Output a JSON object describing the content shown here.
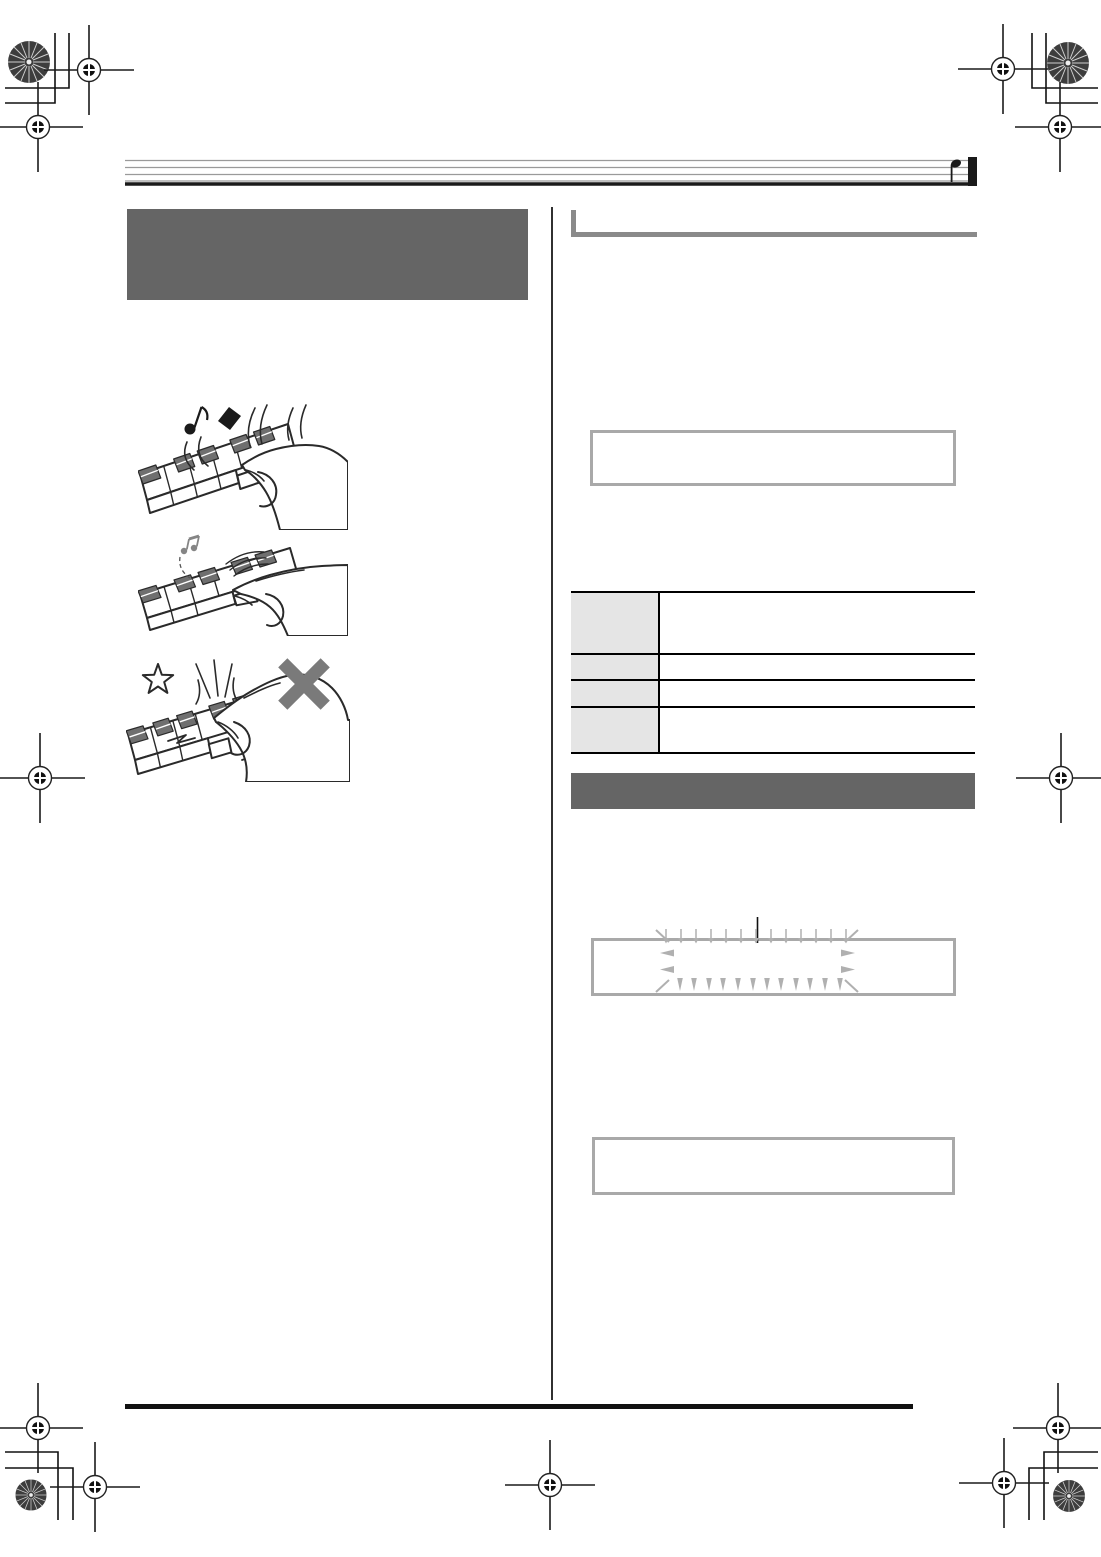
{
  "document": {
    "kind": "printed-manual-page-prepress-proof",
    "visible_text_present": false,
    "columns": 2,
    "page_background": "#ffffff"
  },
  "colors": {
    "heading_block_gray": "#656565",
    "section_bar_gray": "#656565",
    "heading_rule_gray": "#8a8a8a",
    "note_box_border": "#a9a9a9",
    "table_header_bg": "#e5e5e5",
    "table_rule": "#000000",
    "ink": "#1a1a1a",
    "staff_line_gray": "#9a9a9a",
    "display_arrow_gray": "#b0b0b0",
    "illustration_key_gray": "#6f6f6f",
    "prohibit_x_gray": "#787878"
  },
  "header": {
    "staff_lines": 5,
    "end_glyph": "quarter-note-with-final-barline",
    "title_text": ""
  },
  "left_column": {
    "heading_block_text": "",
    "illustrations": [
      {
        "name": "strong-keypress-loud-notes",
        "glyphs": [
          "eighth-note",
          "diamond-note",
          "strike-arcs"
        ]
      },
      {
        "name": "gentle-keypress-soft-note",
        "glyphs": [
          "small-gray-sixteenth-notes",
          "dashed-arc",
          "motion-arcs"
        ]
      },
      {
        "name": "excessive-force-prohibited",
        "glyphs": [
          "star-burst",
          "impact-lines",
          "shock-zigzags",
          "gray-x-mark"
        ]
      }
    ]
  },
  "right_column": {
    "section_1": {
      "heading_text": "",
      "note_box_text": ""
    },
    "table": {
      "rows": 4,
      "columns": 2,
      "row_heights_px": [
        62,
        26,
        27,
        44
      ],
      "header_cells": [
        "",
        "",
        "",
        ""
      ],
      "body_cells": [
        "",
        "",
        "",
        ""
      ]
    },
    "section_2": {
      "heading_bar_text": ""
    },
    "display_box": {
      "tick_mark": "top-center",
      "arrows_top": 13,
      "arrows_bottom": 12,
      "arrows_left": 2,
      "arrows_right": 2,
      "corner_marks": 4
    },
    "note_box_2_text": ""
  },
  "footer": {
    "rule": "thick-black",
    "page_number_text": ""
  },
  "registration_marks": {
    "corner_clusters": 4,
    "edge_targets": [
      "left-middle",
      "right-middle",
      "bottom-center"
    ],
    "elements": [
      "pinwheel-disc",
      "crosshair-target",
      "corner-bracket-lines"
    ]
  }
}
